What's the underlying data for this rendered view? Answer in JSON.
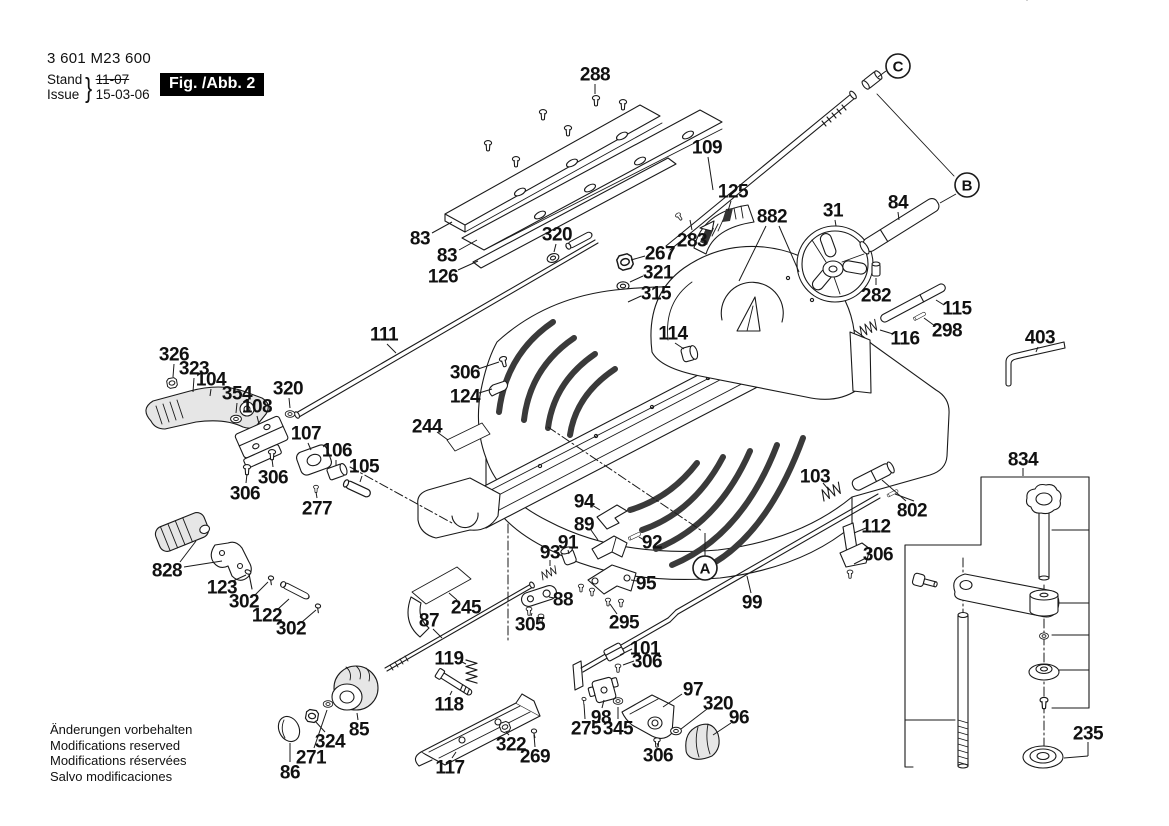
{
  "doc": {
    "part_number": "3 601 M23 600",
    "stand_label": "Stand",
    "issue_label": "Issue",
    "stand_value": "11-07",
    "issue_value": "15-03-06",
    "figure_label": "Fig. /Abb. 2",
    "footer_lines": [
      "Änderungen vorbehalten",
      "Modifications reserved",
      "Modifications réservées",
      "Salvo modificaciones"
    ]
  },
  "colors": {
    "ink": "#1a1a1a",
    "paper": "#ffffff",
    "figure_box_bg": "#000000",
    "figure_box_fg": "#ffffff"
  },
  "section_markers": [
    "A",
    "B",
    "C"
  ],
  "callouts": [
    {
      "t": "288",
      "x": 595,
      "y": 74,
      "leaders": [
        [
          595,
          84,
          595,
          94
        ]
      ]
    },
    {
      "t": "109",
      "x": 707,
      "y": 147,
      "leaders": [
        [
          708,
          157,
          713,
          190
        ]
      ]
    },
    {
      "t": "C",
      "x": 898,
      "y": 66,
      "circled": true,
      "leaders": [
        [
          886,
          71,
          878,
          77
        ]
      ]
    },
    {
      "t": "83",
      "x": 420,
      "y": 238,
      "leaders": [
        [
          432,
          233,
          452,
          222
        ]
      ]
    },
    {
      "t": "83",
      "x": 447,
      "y": 255,
      "leaders": [
        [
          459,
          250,
          477,
          240
        ]
      ]
    },
    {
      "t": "126",
      "x": 443,
      "y": 276,
      "leaders": [
        [
          458,
          270,
          478,
          261
        ]
      ]
    },
    {
      "t": "320",
      "x": 557,
      "y": 234,
      "leaders": [
        [
          556,
          244,
          554,
          252
        ]
      ]
    },
    {
      "t": "111",
      "x": 384,
      "y": 334,
      "leaders": [
        [
          387,
          344,
          396,
          353
        ]
      ]
    },
    {
      "t": "125",
      "x": 733,
      "y": 191,
      "leaders": [
        [
          731,
          201,
          728,
          211
        ]
      ]
    },
    {
      "t": "882",
      "x": 772,
      "y": 216,
      "leaders": [
        [
          766,
          226,
          739,
          281
        ],
        [
          779,
          226,
          799,
          272
        ]
      ]
    },
    {
      "t": "283",
      "x": 692,
      "y": 240,
      "leaders": [
        [
          692,
          230,
          690,
          220
        ]
      ]
    },
    {
      "t": "31",
      "x": 833,
      "y": 210,
      "leaders": [
        [
          835,
          220,
          836,
          226
        ]
      ]
    },
    {
      "t": "84",
      "x": 898,
      "y": 202,
      "leaders": [
        [
          898,
          212,
          899,
          220
        ]
      ]
    },
    {
      "t": "B",
      "x": 967,
      "y": 185,
      "circled": true,
      "leaders": [
        [
          956,
          194,
          940,
          203
        ]
      ]
    },
    {
      "t": "267",
      "x": 660,
      "y": 253,
      "leaders": [
        [
          645,
          256,
          631,
          260
        ]
      ]
    },
    {
      "t": "321",
      "x": 658,
      "y": 272,
      "leaders": [
        [
          643,
          276,
          630,
          282
        ]
      ]
    },
    {
      "t": "315",
      "x": 656,
      "y": 293,
      "leaders": [
        [
          641,
          296,
          628,
          302
        ]
      ]
    },
    {
      "t": "282",
      "x": 876,
      "y": 295,
      "leaders": [
        [
          876,
          285,
          876,
          278
        ]
      ]
    },
    {
      "t": "115",
      "x": 957,
      "y": 308,
      "leaders": [
        [
          944,
          305,
          936,
          300
        ]
      ]
    },
    {
      "t": "116",
      "x": 905,
      "y": 338,
      "leaders": [
        [
          893,
          334,
          880,
          330
        ]
      ]
    },
    {
      "t": "298",
      "x": 947,
      "y": 330,
      "leaders": [
        [
          935,
          326,
          924,
          318
        ]
      ]
    },
    {
      "t": "403",
      "x": 1040,
      "y": 337,
      "leaders": [
        [
          1038,
          347,
          1036,
          352
        ]
      ]
    },
    {
      "t": "114",
      "x": 673,
      "y": 333,
      "leaders": [
        [
          675,
          343,
          684,
          349
        ]
      ]
    },
    {
      "t": "306",
      "x": 465,
      "y": 372,
      "leaders": [
        [
          478,
          369,
          499,
          362
        ]
      ]
    },
    {
      "t": "124",
      "x": 465,
      "y": 396,
      "leaders": [
        [
          479,
          393,
          492,
          389
        ]
      ]
    },
    {
      "t": "244",
      "x": 427,
      "y": 426,
      "leaders": [
        [
          437,
          432,
          448,
          440
        ]
      ]
    },
    {
      "t": "326",
      "x": 174,
      "y": 354,
      "leaders": [
        [
          174,
          364,
          173,
          377
        ]
      ]
    },
    {
      "t": "323",
      "x": 194,
      "y": 368,
      "leaders": [
        [
          194,
          378,
          193,
          392
        ]
      ]
    },
    {
      "t": "104",
      "x": 211,
      "y": 379,
      "leaders": [
        [
          211,
          389,
          210,
          396
        ]
      ]
    },
    {
      "t": "354",
      "x": 237,
      "y": 393,
      "leaders": [
        [
          237,
          403,
          236,
          413
        ]
      ]
    },
    {
      "t": "108",
      "x": 257,
      "y": 406,
      "leaders": [
        [
          257,
          416,
          259,
          424
        ]
      ]
    },
    {
      "t": "320",
      "x": 288,
      "y": 388,
      "leaders": [
        [
          289,
          398,
          290,
          408
        ]
      ]
    },
    {
      "t": "107",
      "x": 306,
      "y": 433,
      "leaders": [
        [
          308,
          443,
          311,
          450
        ]
      ]
    },
    {
      "t": "106",
      "x": 337,
      "y": 450,
      "leaders": [
        [
          336,
          460,
          336,
          466
        ]
      ]
    },
    {
      "t": "105",
      "x": 364,
      "y": 466,
      "leaders": [
        [
          362,
          476,
          360,
          482
        ]
      ]
    },
    {
      "t": "306",
      "x": 273,
      "y": 477,
      "leaders": [
        [
          273,
          467,
          272,
          459
        ]
      ]
    },
    {
      "t": "306",
      "x": 245,
      "y": 493,
      "leaders": [
        [
          246,
          483,
          247,
          474
        ]
      ]
    },
    {
      "t": "277",
      "x": 317,
      "y": 508,
      "leaders": [
        [
          317,
          498,
          316,
          492
        ]
      ]
    },
    {
      "t": "828",
      "x": 167,
      "y": 570,
      "leaders": [
        [
          180,
          562,
          196,
          541
        ],
        [
          184,
          567,
          222,
          561
        ]
      ]
    },
    {
      "t": "123",
      "x": 222,
      "y": 587,
      "leaders": [
        [
          233,
          581,
          246,
          575
        ]
      ]
    },
    {
      "t": "302",
      "x": 244,
      "y": 601,
      "leaders": [
        [
          255,
          595,
          268,
          582
        ]
      ]
    },
    {
      "t": "122",
      "x": 267,
      "y": 615,
      "leaders": [
        [
          278,
          609,
          289,
          599
        ]
      ]
    },
    {
      "t": "302",
      "x": 291,
      "y": 628,
      "leaders": [
        [
          302,
          622,
          316,
          610
        ]
      ]
    },
    {
      "t": "87",
      "x": 429,
      "y": 620,
      "leaders": [
        [
          433,
          629,
          442,
          638
        ]
      ]
    },
    {
      "t": "245",
      "x": 466,
      "y": 607,
      "leaders": [
        [
          457,
          600,
          449,
          593
        ]
      ]
    },
    {
      "t": "305",
      "x": 530,
      "y": 624,
      "leaders": [
        [
          531,
          616,
          532,
          613
        ]
      ]
    },
    {
      "t": "88",
      "x": 563,
      "y": 599,
      "leaders": [
        [
          554,
          598,
          549,
          597
        ]
      ]
    },
    {
      "t": "93",
      "x": 550,
      "y": 552,
      "leaders": [
        [
          550,
          560,
          550,
          566
        ]
      ]
    },
    {
      "t": "91",
      "x": 568,
      "y": 542,
      "leaders": [
        [
          568,
          550,
          569,
          554
        ]
      ]
    },
    {
      "t": "89",
      "x": 584,
      "y": 524,
      "leaders": [
        [
          591,
          530,
          598,
          540
        ]
      ]
    },
    {
      "t": "94",
      "x": 584,
      "y": 501,
      "leaders": [
        [
          592,
          505,
          600,
          510
        ]
      ]
    },
    {
      "t": "92",
      "x": 652,
      "y": 542,
      "leaders": [
        [
          644,
          540,
          639,
          537
        ]
      ]
    },
    {
      "t": "95",
      "x": 646,
      "y": 583,
      "leaders": [
        [
          637,
          581,
          631,
          580
        ]
      ]
    },
    {
      "t": "295",
      "x": 624,
      "y": 622,
      "leaders": [
        [
          617,
          614,
          610,
          604
        ]
      ]
    },
    {
      "t": "119",
      "x": 449,
      "y": 658,
      "leaders": [
        [
          460,
          661,
          466,
          664
        ]
      ]
    },
    {
      "t": "118",
      "x": 449,
      "y": 704,
      "leaders": [
        [
          450,
          695,
          452,
          691
        ]
      ]
    },
    {
      "t": "117",
      "x": 450,
      "y": 767,
      "leaders": [
        [
          452,
          758,
          456,
          752
        ]
      ]
    },
    {
      "t": "85",
      "x": 359,
      "y": 729,
      "leaders": [
        [
          358,
          720,
          357,
          713
        ]
      ]
    },
    {
      "t": "324",
      "x": 330,
      "y": 741,
      "leaders": [
        [
          325,
          732,
          315,
          721
        ]
      ]
    },
    {
      "t": "271",
      "x": 311,
      "y": 757,
      "leaders": [
        [
          314,
          748,
          327,
          710
        ]
      ]
    },
    {
      "t": "86",
      "x": 290,
      "y": 772,
      "leaders": [
        [
          290,
          762,
          290,
          743
        ]
      ]
    },
    {
      "t": "322",
      "x": 511,
      "y": 744,
      "leaders": [
        [
          509,
          735,
          506,
          732
        ]
      ]
    },
    {
      "t": "269",
      "x": 535,
      "y": 756,
      "leaders": [
        [
          535,
          747,
          534,
          735
        ]
      ]
    },
    {
      "t": "99",
      "x": 752,
      "y": 602,
      "leaders": [
        [
          751,
          593,
          747,
          576
        ]
      ]
    },
    {
      "t": "A",
      "x": 705,
      "y": 568,
      "circled": true,
      "leaders": [
        [
          705,
          556,
          705,
          533
        ]
      ]
    },
    {
      "t": "101",
      "x": 645,
      "y": 648,
      "leaders": [
        [
          632,
          649,
          620,
          655
        ]
      ]
    },
    {
      "t": "306",
      "x": 647,
      "y": 661,
      "leaders": [
        [
          634,
          661,
          623,
          665
        ]
      ]
    },
    {
      "t": "98",
      "x": 601,
      "y": 717,
      "leaders": [
        [
          602,
          708,
          604,
          700
        ]
      ]
    },
    {
      "t": "275",
      "x": 586,
      "y": 728,
      "leaders": [
        [
          585,
          719,
          584,
          704
        ]
      ]
    },
    {
      "t": "345",
      "x": 618,
      "y": 728,
      "leaders": [
        [
          618,
          719,
          618,
          707
        ]
      ]
    },
    {
      "t": "97",
      "x": 693,
      "y": 689,
      "leaders": [
        [
          682,
          694,
          663,
          707
        ]
      ]
    },
    {
      "t": "320",
      "x": 718,
      "y": 703,
      "leaders": [
        [
          707,
          709,
          681,
          729
        ]
      ]
    },
    {
      "t": "96",
      "x": 739,
      "y": 717,
      "leaders": [
        [
          731,
          723,
          713,
          735
        ]
      ]
    },
    {
      "t": "306",
      "x": 658,
      "y": 755,
      "leaders": [
        [
          658,
          746,
          657,
          743
        ]
      ]
    },
    {
      "t": "103",
      "x": 815,
      "y": 476,
      "leaders": [
        [
          823,
          483,
          829,
          490
        ]
      ]
    },
    {
      "t": "802",
      "x": 912,
      "y": 510,
      "leaders": [
        [
          906,
          501,
          882,
          480
        ],
        [
          914,
          501,
          895,
          494
        ]
      ]
    },
    {
      "t": "112",
      "x": 876,
      "y": 526,
      "leaders": [
        [
          866,
          528,
          854,
          533
        ]
      ]
    },
    {
      "t": "306",
      "x": 878,
      "y": 554,
      "leaders": [
        [
          866,
          558,
          854,
          564
        ]
      ]
    },
    {
      "t": "834",
      "x": 1023,
      "y": 459,
      "leaders": [
        [
          1023,
          468,
          1023,
          476
        ]
      ]
    },
    {
      "t": "235",
      "x": 1088,
      "y": 733,
      "leaders": [
        [
          1088,
          742,
          1088,
          756
        ],
        [
          1088,
          756,
          1064,
          758
        ]
      ]
    }
  ]
}
